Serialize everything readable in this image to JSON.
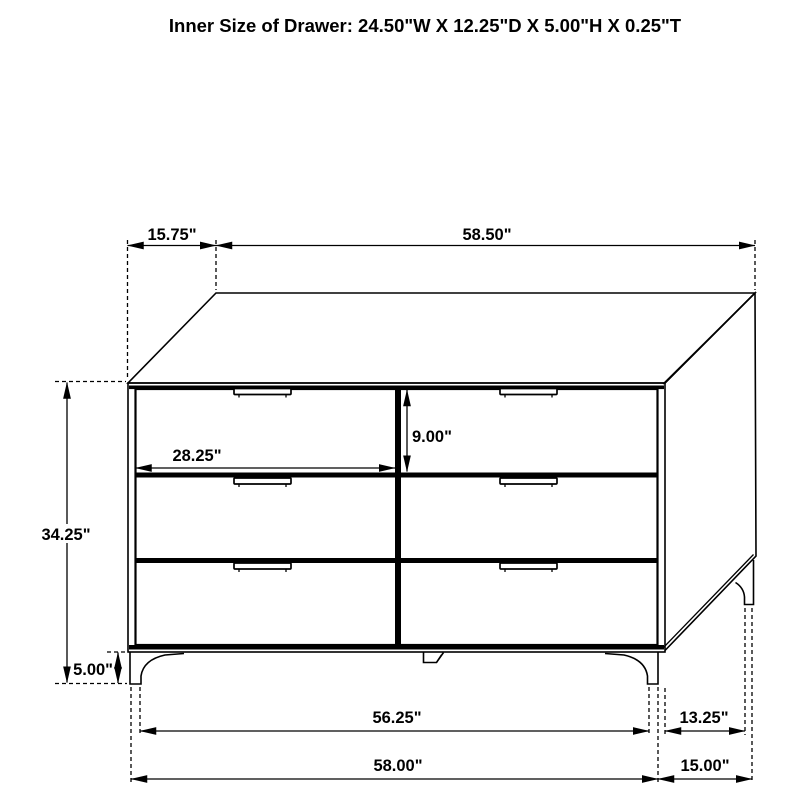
{
  "title": "Inner Size of Drawer: 24.50\"W X 12.25\"D X 5.00\"H X 0.25\"T",
  "dims": {
    "top_depth": "15.75\"",
    "top_width": "58.50\"",
    "drawer_width": "28.25\"",
    "drawer_height": "9.00\"",
    "body_height": "34.25\"",
    "leg_height": "5.00\"",
    "front_leg_span": "56.25\"",
    "overall_width": "58.00\"",
    "side_leg_span": "13.25\"",
    "overall_depth": "15.00\""
  },
  "colors": {
    "line": "#000000",
    "background": "#ffffff"
  }
}
